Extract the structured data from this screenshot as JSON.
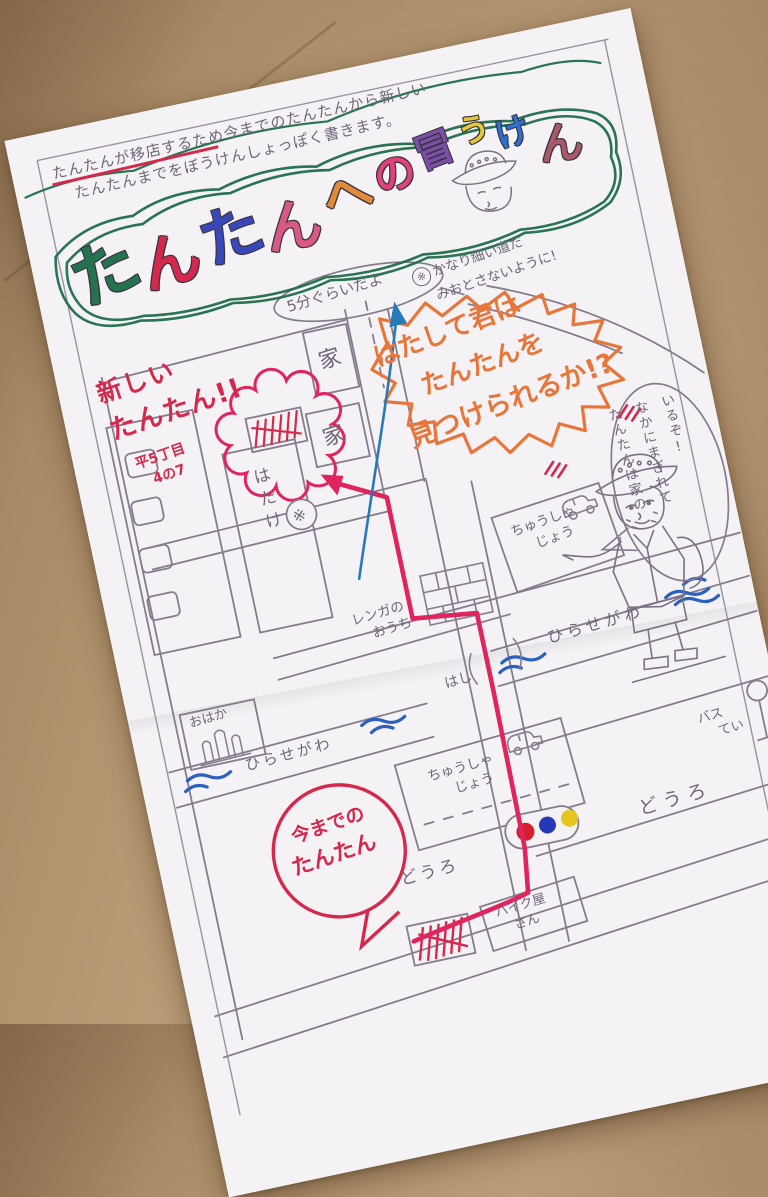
{
  "colors": {
    "cardboard": "#b2946f",
    "paper": "#f4f2f4",
    "pencil": "#6f6678",
    "route_red": "#e0245e",
    "marker_red": "#d4294d",
    "arrow_blue": "#2779b8",
    "river_blue": "#2b5fc0",
    "burst_orange": "#e8763a",
    "wreath_green": "#1f6e4a",
    "traffic_red": "#d61f2c",
    "traffic_blue": "#2438b8",
    "traffic_yellow": "#e6c51f"
  },
  "intro": {
    "line1": "たんたんが移店するため今までのたんたんから新しい",
    "line2": "たんたんまでをぼうけんしょっぽく書きます。"
  },
  "title": {
    "letters": [
      {
        "ch": "た",
        "color": "#27724e"
      },
      {
        "ch": "ん",
        "color": "#d4294d"
      },
      {
        "ch": "た",
        "color": "#3947b8"
      },
      {
        "ch": "ん",
        "color": "#d85a80"
      },
      {
        "ch": "へ",
        "color": "#e08a3c"
      },
      {
        "ch": "の",
        "color": "#e0427a"
      },
      {
        "ch": "冒",
        "color": "#7b4fa6"
      },
      {
        "ch": "う",
        "color": "#e6c832"
      },
      {
        "ch": "け",
        "color": "#2f6fd0"
      },
      {
        "ch": "ん",
        "color": "#a85a68"
      }
    ]
  },
  "bubbles": {
    "five_min": "5分ぐらいだよ",
    "ref_mark": "※",
    "narrow1": "かなり細い道だ",
    "narrow2": "みおとさないように!",
    "challenge1": "はたして君は",
    "challenge2": "たんたんを",
    "challenge3": "見つけられるか!?",
    "hint1": "たんたんは家の",
    "hint2": "なかにまぎれて",
    "hint3": "いるぞ!",
    "old1": "今までの",
    "old2": "たんたん"
  },
  "new_tantan": {
    "line1": "新しい",
    "line2": "たんたん!!",
    "addr1": "平5丁目",
    "addr2": "4の7"
  },
  "labels": {
    "house": "家",
    "field": "はたけ",
    "grave": "おはか",
    "brick1": "レンガの",
    "brick2": "おうち",
    "park1": "ちゅうしゃ",
    "park2": "じょう",
    "river": "ひらせがわ",
    "bridge": "はし",
    "road": "どうろ",
    "bus1": "バス",
    "bus2": "てい",
    "bike1": "バイク屋",
    "bike2": "さん"
  }
}
